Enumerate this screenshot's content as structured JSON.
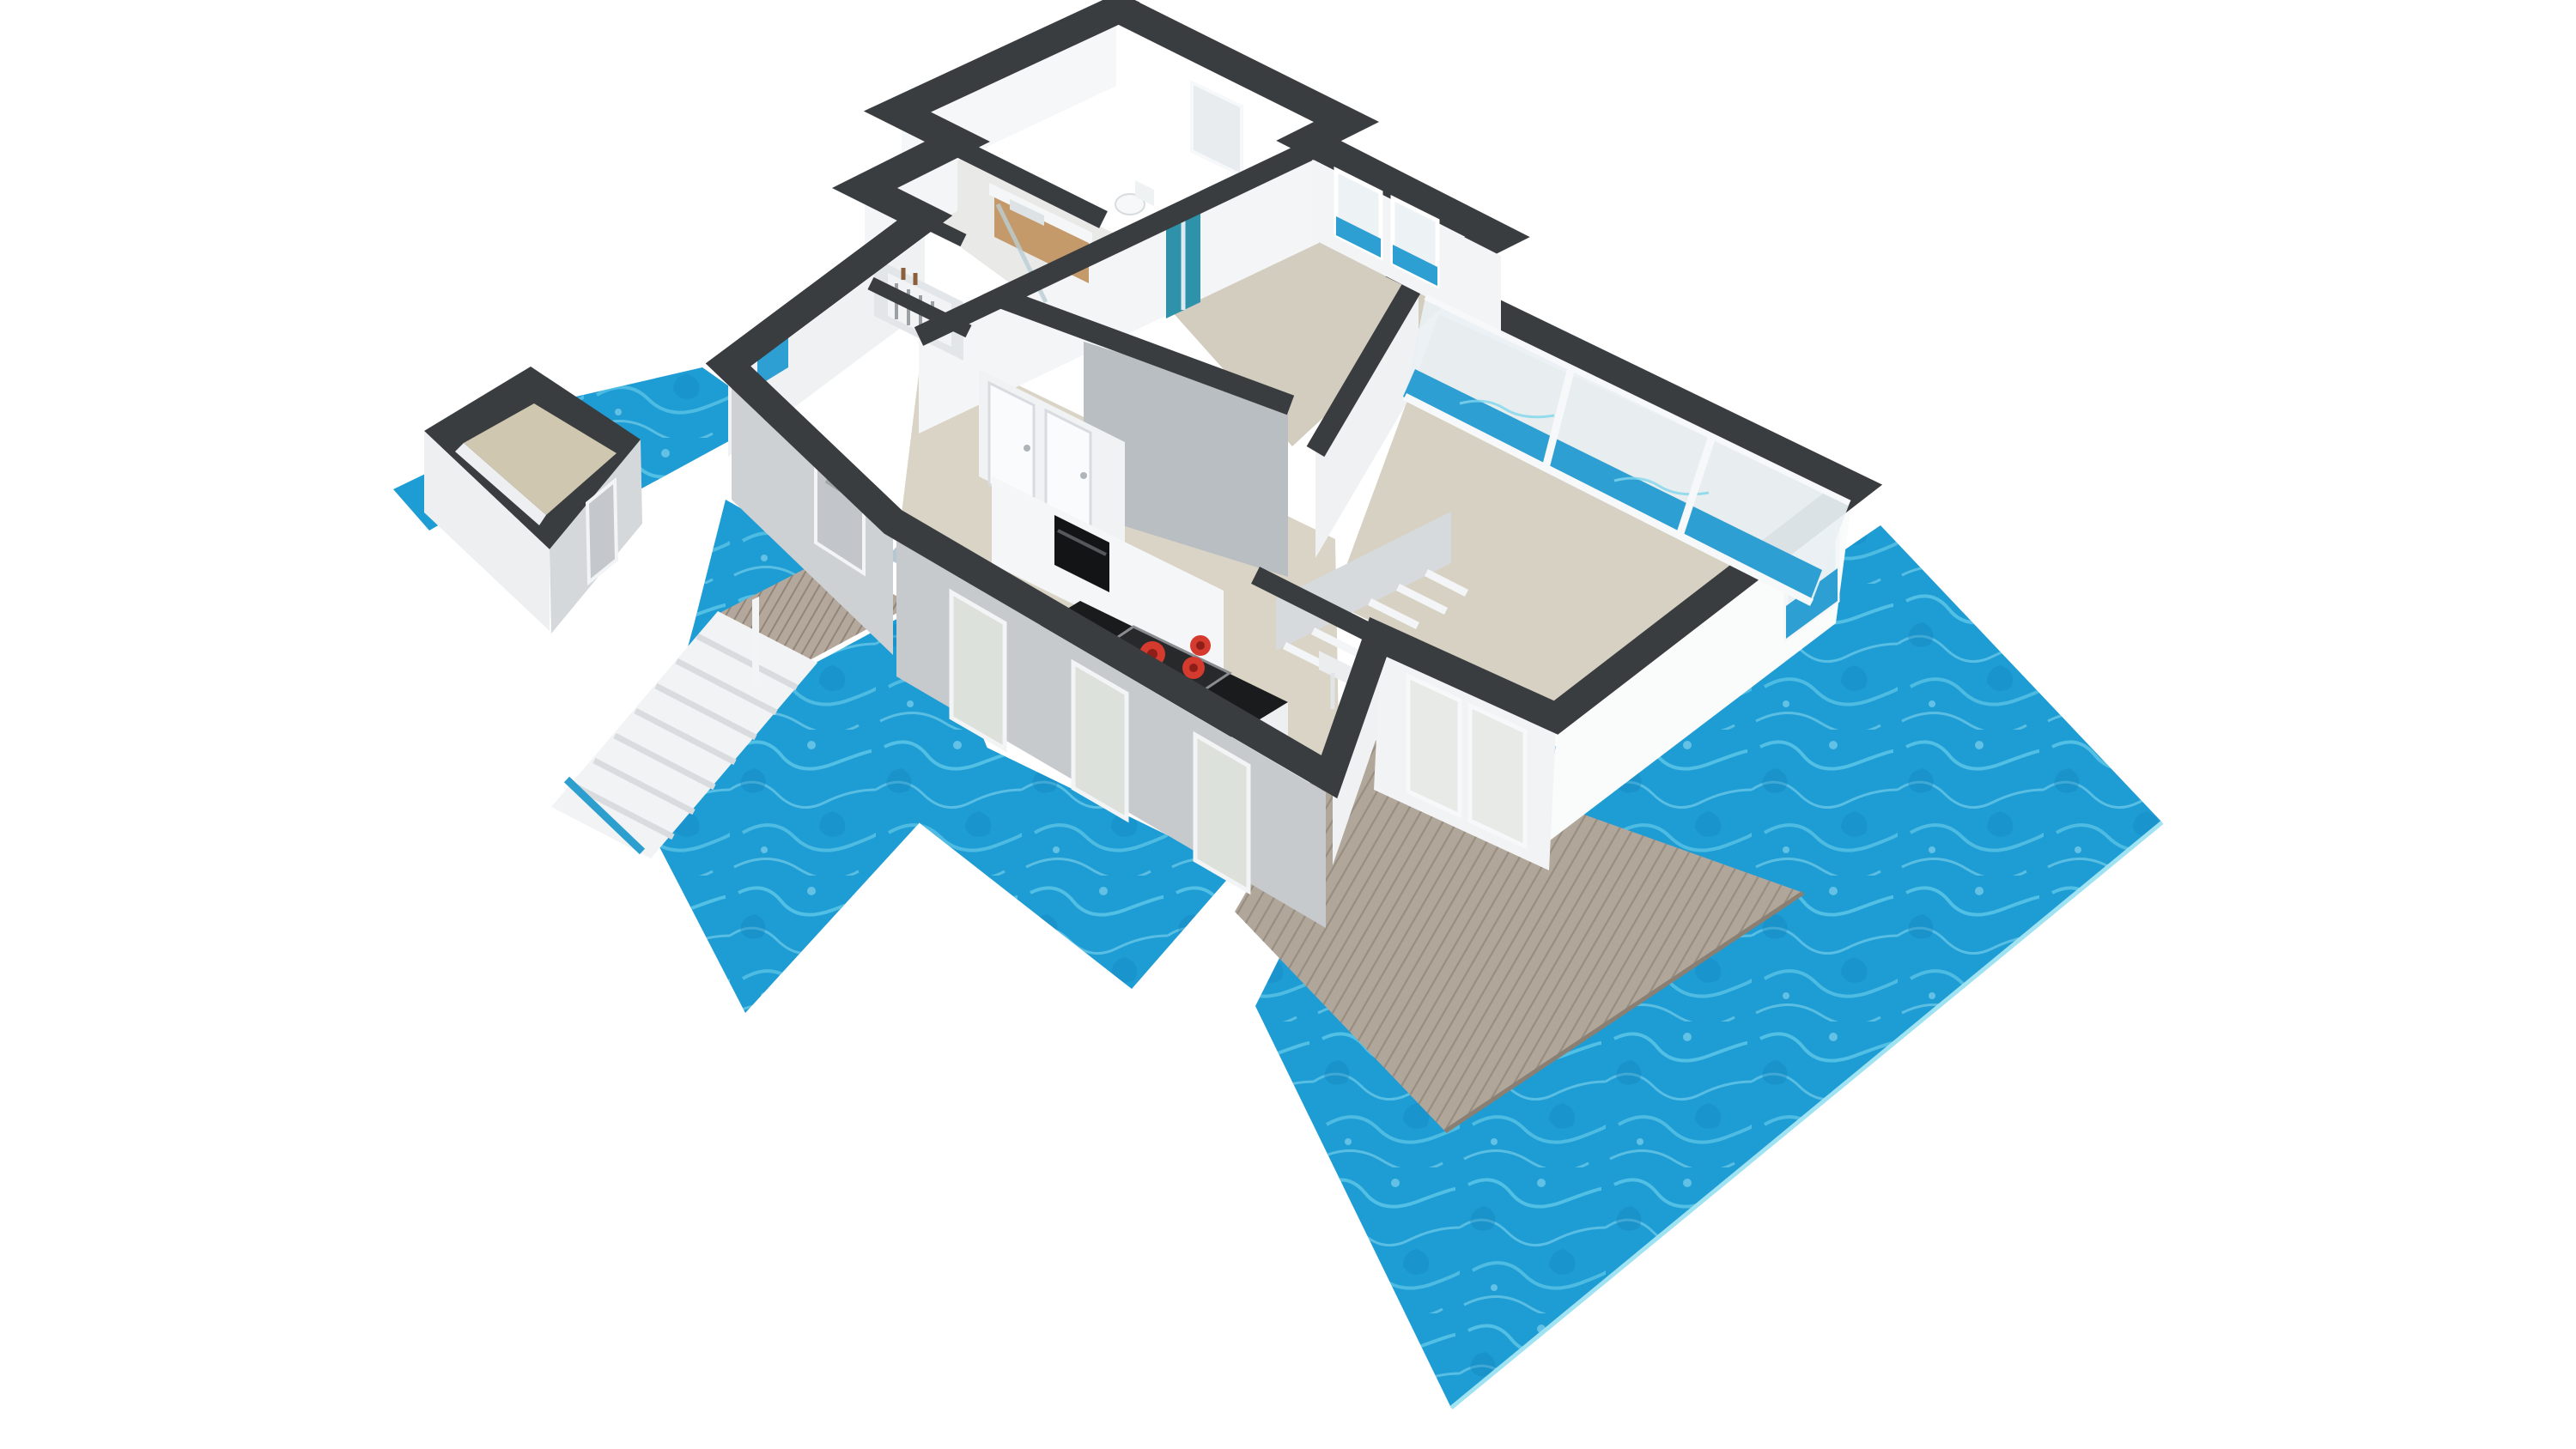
{
  "meta": {
    "description": "3D isometric floor plan of a single-storey waterfront houseboat: bathroom, bedroom, hallway, kitchen with cooktop island, living room with glass walls, internal staircase, separate shed, exterior stairs, wooden decks, surrounded by blue water",
    "scene_type": "3d-floorplan-render"
  },
  "palette": {
    "bg": "#FFFFFF",
    "water-base": "#1E9CD4",
    "water-light": "#63CBE9",
    "water-deep": "#1181BA",
    "water-edge": "#9FE2F2",
    "cap": "#3A3D40",
    "wall-white": "#F7F8F9",
    "wall-light": "#EDEFF1",
    "wall-mid": "#DDE0E3",
    "wall-gray": "#C8CCCF",
    "wall-dark": "#B6BABE",
    "floor-main": "#D9D4C6",
    "floor-bedroom": "#D2CDBE",
    "floor-bath": "#E9E9E7",
    "floor-shed": "#CFC7B0",
    "glass": "#E9F0F3",
    "window-water": "#2E9FD2",
    "deck-wood": "#B1A69A",
    "deck-line": "#93887B",
    "stair-top": "#F2F3F4",
    "stair-riser": "#D9DCDF",
    "counter-black": "#1A1B1D",
    "cooktop": "#28292B",
    "burner-red": "#D43A2E",
    "burner-dark": "#8E1F18",
    "backsplash-blue": "#B5C7D1",
    "cabinet-white": "#F4F5F6",
    "oven-black": "#131415",
    "wood-vanity": "#C59A6B",
    "teal-door": "#2E92AB",
    "railing": "#EBEDEF",
    "shed-door": "#C4C8CC"
  },
  "structure": {
    "rooms": [
      "bathroom",
      "bedroom",
      "hallway",
      "kitchen",
      "living-room"
    ],
    "outbuildings": [
      "shed"
    ],
    "exterior": [
      "water",
      "main-deck",
      "entrance-walkway",
      "exterior-stairs"
    ],
    "features": {
      "cooktop_burners": 4,
      "interior_stair_steps": 7,
      "exterior_stair_steps": 7,
      "living_glass_panels": 3,
      "bedroom_windows": 2
    }
  }
}
